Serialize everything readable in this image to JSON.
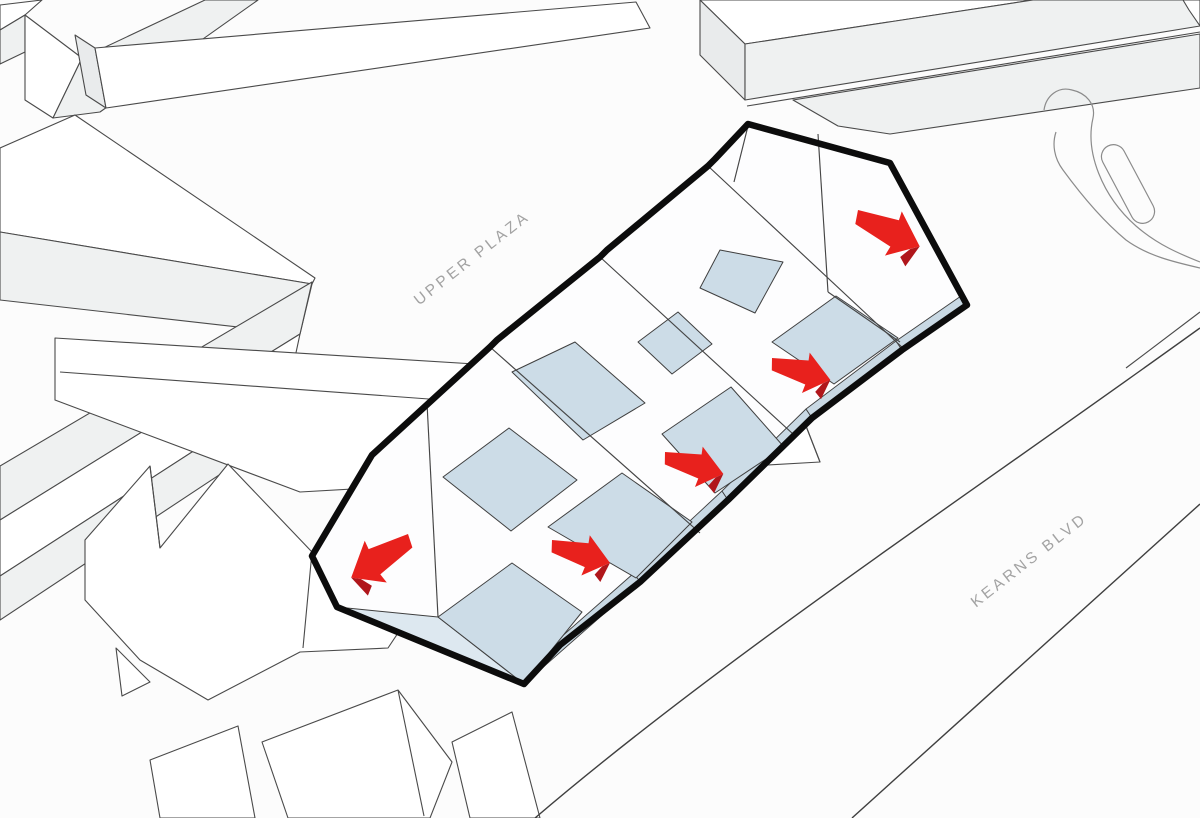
{
  "diagram": {
    "type": "axonometric-site-diagram",
    "labels": {
      "plaza": "UPPER PLAZA",
      "road": "KEARNS BLVD"
    },
    "colors": {
      "background": "#fcfcfc",
      "accent_red": "#e8211d",
      "accent_red_dark": "#b0161b",
      "roof_blue": "#ccdce7",
      "roof_blue_light": "#dde8f0",
      "eave_blue": "#c9d9e4",
      "outline_black": "#0c0c0c",
      "line_gray": "#4a4a4a",
      "label_gray": "#a3a3a3",
      "face_white": "#ffffff",
      "face_light": "#eff1f1"
    },
    "arrows": [
      {
        "id": "west-exit",
        "direction": "down-left",
        "x": 408,
        "y": 534,
        "rotation": 148,
        "scale": 1.15,
        "mirror": true
      },
      {
        "id": "bay-1",
        "direction": "down-right",
        "x": 552,
        "y": 540,
        "rotation": 16,
        "scale": 1.0,
        "mirror": false
      },
      {
        "id": "bay-2",
        "direction": "down-right",
        "x": 665,
        "y": 452,
        "rotation": 15,
        "scale": 1.0,
        "mirror": false
      },
      {
        "id": "bay-3",
        "direction": "down-right",
        "x": 772,
        "y": 358,
        "rotation": 15,
        "scale": 1.0,
        "mirror": false
      },
      {
        "id": "east-entry",
        "direction": "down-right",
        "x": 858,
        "y": 210,
        "rotation": 25,
        "scale": 1.15,
        "mirror": false
      }
    ]
  }
}
